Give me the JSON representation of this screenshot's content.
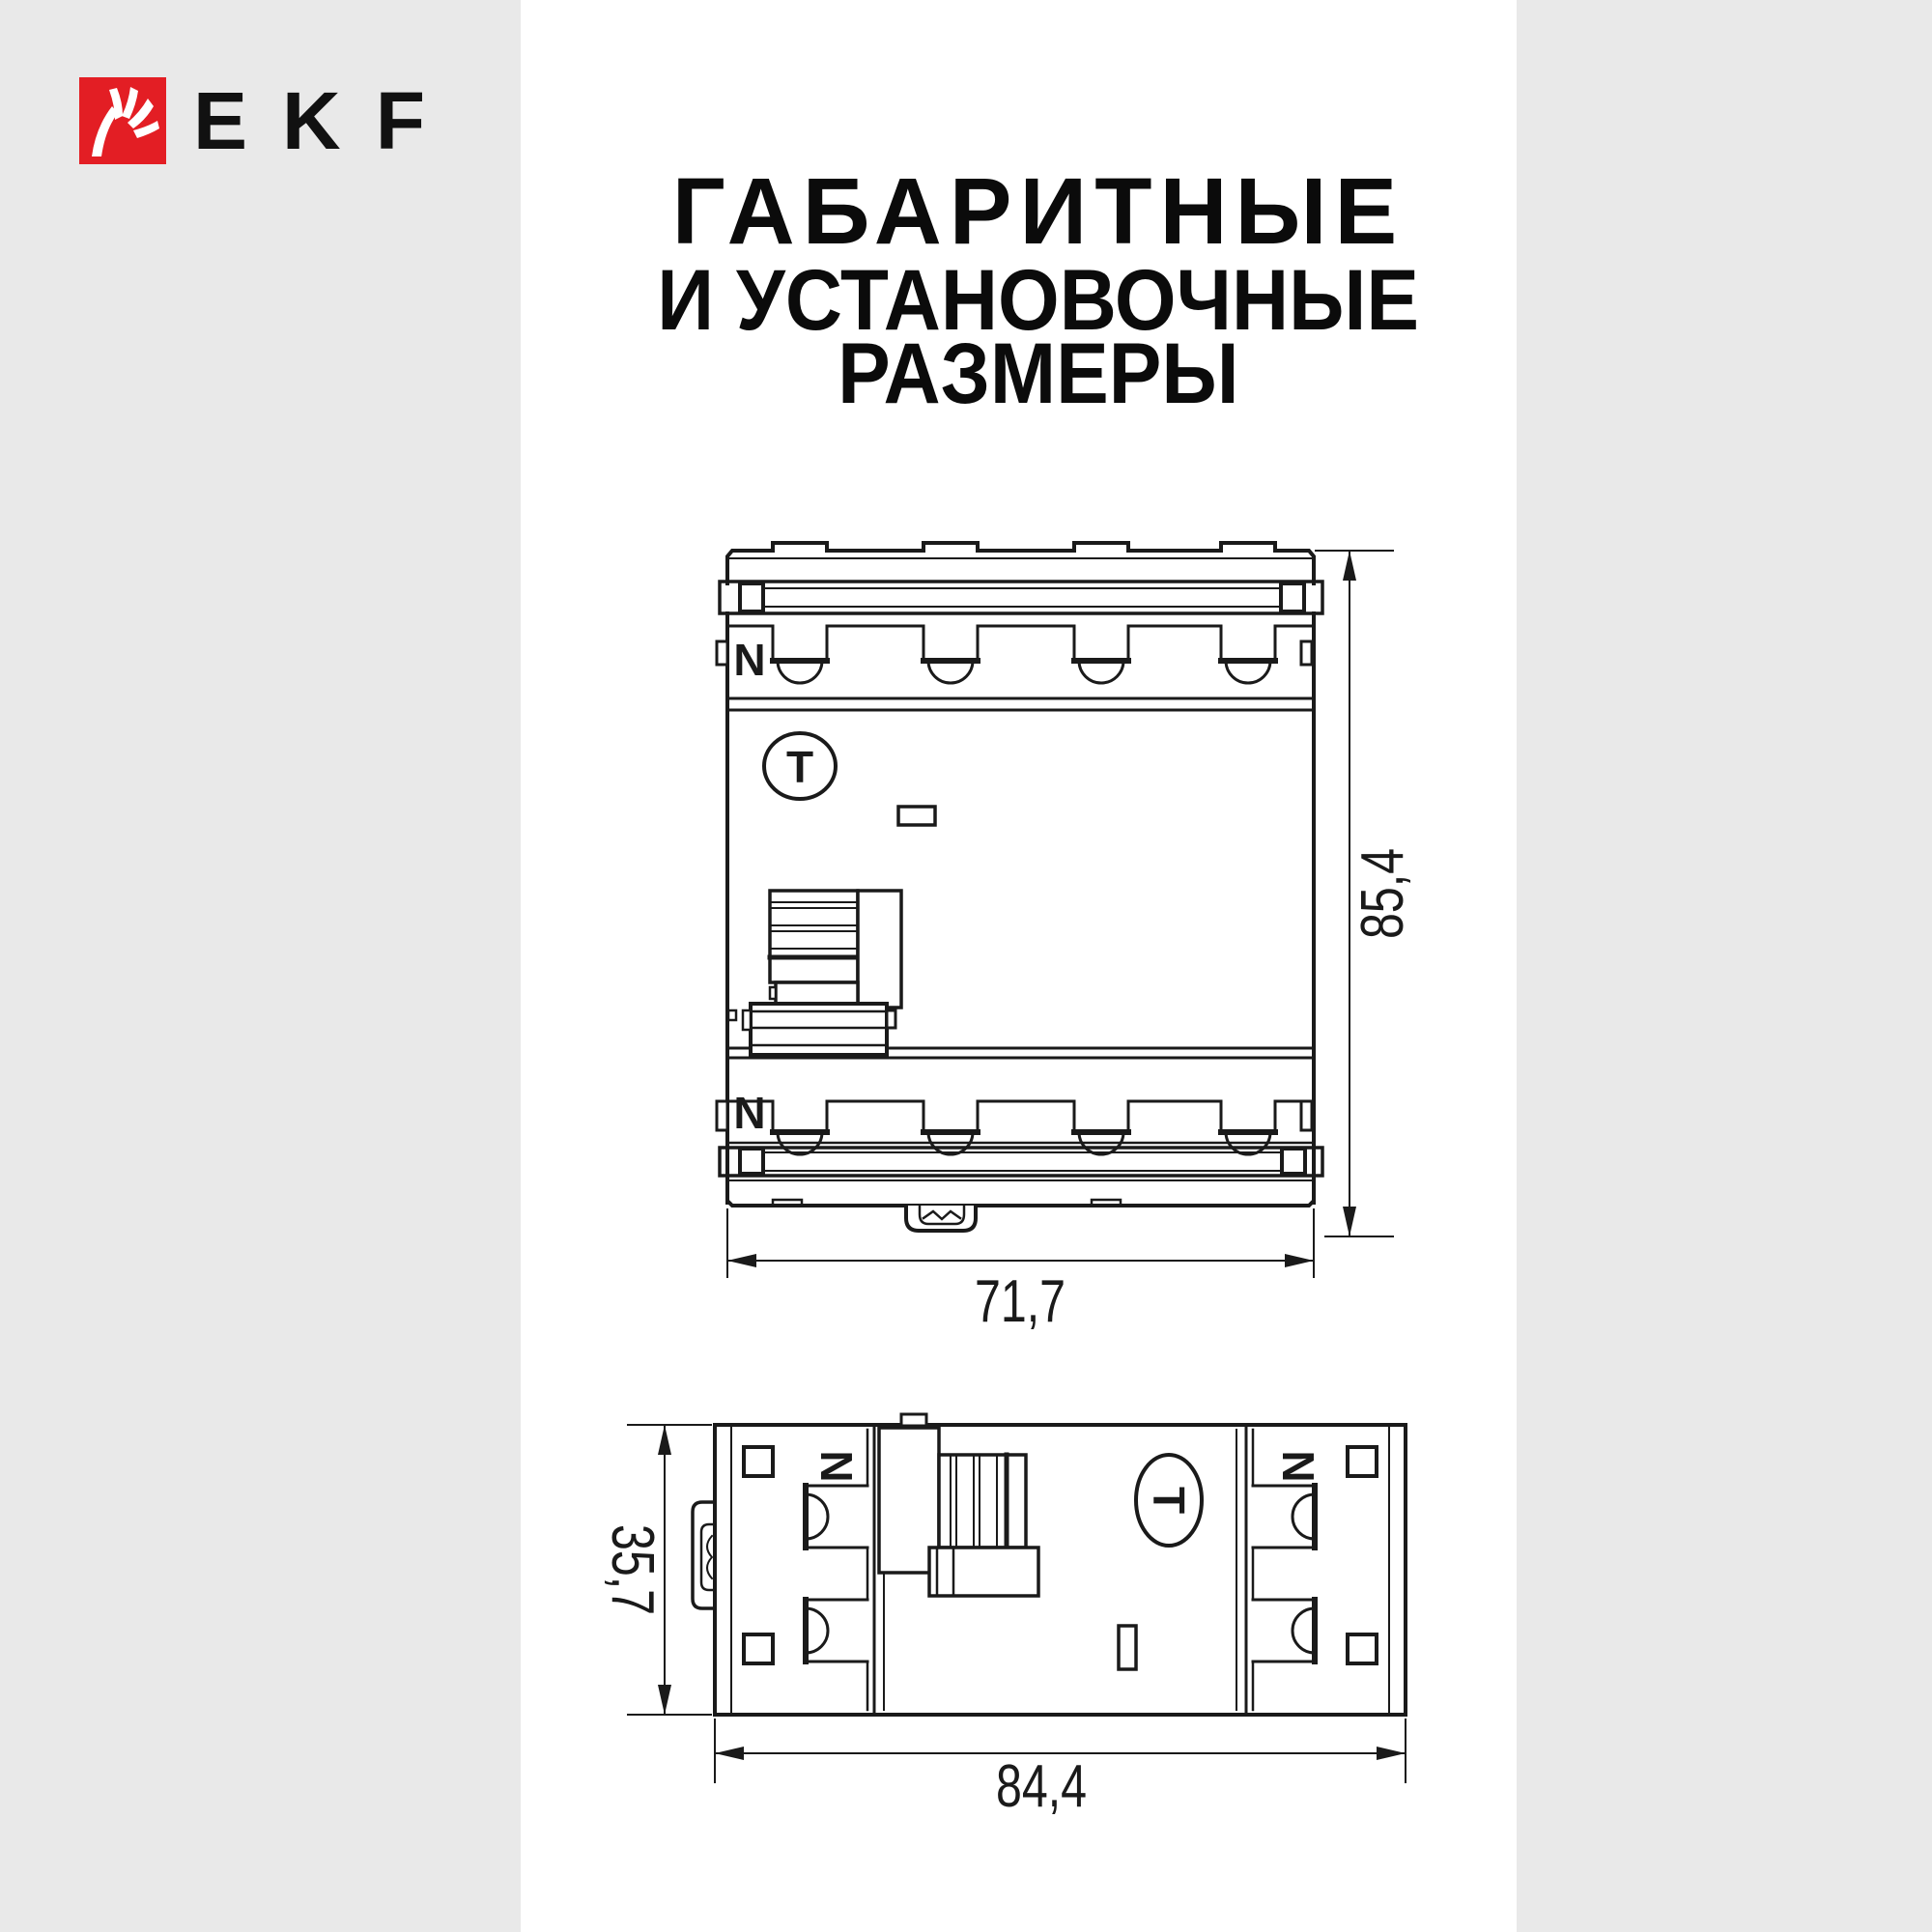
{
  "meta": {
    "background_color": "#e9e9e9",
    "panel_color": "#ffffff",
    "ink_color": "#1a1a1a",
    "brand_red": "#e31e24"
  },
  "logo": {
    "brand": "EKF"
  },
  "title": {
    "line1": "ГАБАРИТНЫЕ",
    "line2": "И УСТАНОВОЧНЫЕ",
    "line3": "РАЗМЕРЫ"
  },
  "front_view": {
    "width_mm": "71,7",
    "height_mm": "85,4",
    "neutral_label": "N",
    "test_label": "T"
  },
  "bottom_view": {
    "depth_mm": "35,7",
    "width_mm": "84,4",
    "neutral_label": "N",
    "test_label": "T"
  }
}
